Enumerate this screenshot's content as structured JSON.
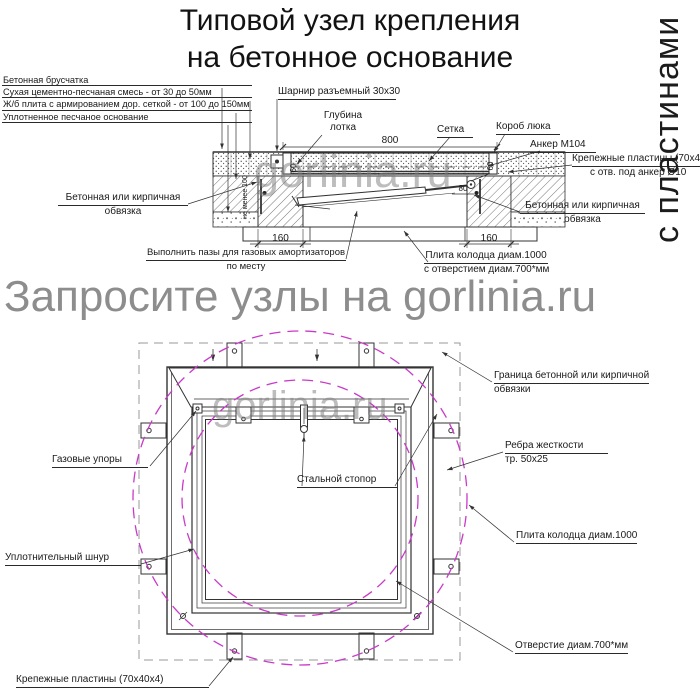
{
  "title": {
    "line1": "Типовой узел крепления",
    "line2": "на бетонное основание"
  },
  "watermark": {
    "vertical": "с пластинами",
    "banner": "Запросите узлы на gorlinia.ru",
    "site": "gorlinia.ru"
  },
  "section": {
    "layer_labels": {
      "l1": "Бетонная брусчатка",
      "l2": "Сухая цементно-песчаная смесь - от 30 до 50мм",
      "l3": "Ж/б плита с армированием дор. сеткой - от 100 до 150мм",
      "l4": "Уплотненное песчаное основание"
    },
    "labels": {
      "hinge": "Шарнир разъемный 30x30",
      "depth_line1": "Глубина",
      "depth_line2": "лотка",
      "mesh": "Сетка",
      "box": "Короб люка",
      "anchor": "Анкер М104",
      "plates_line1": "Крепежные пластины (70x40x4)",
      "plates_line2": "с отв. под анкер Ø10",
      "edging_line1": "Бетонная или кирпичная",
      "edging_line2": "обвязка",
      "grooves_line1": "Выполнить пазы для газовых амортизаторов",
      "grooves_line2": "по месту",
      "slab_line1": "Плита колодца диам.1000",
      "slab_line2": "с отверстием диам.700*мм"
    },
    "dims": {
      "width": "800",
      "left_offset": "160",
      "right_offset": "160",
      "depth_left": "60",
      "depth_right": "60",
      "anchor_offset": "80",
      "min_depth": "не менее 100"
    }
  },
  "plan": {
    "labels": {
      "border_line1": "Граница бетонной или кирпичной",
      "border_line2": "обвязки",
      "gas_struts": "Газовые упоры",
      "stopper": "Стальной стопор",
      "ribs_line1": "Ребра жесткости",
      "ribs_line2": "тр. 50x25",
      "slab": "Плита колодца диам.1000",
      "cord": "Уплотнительный шнур",
      "hole": "Отверстие диам.700*мм",
      "plates": "Крепежные пластины (70x40x4)"
    }
  },
  "colors": {
    "line": "#333333",
    "circle_magenta": "#c93ac9",
    "border_dashed_gray": "#9a9a9a",
    "watermark_gray": "#8d8d8d"
  }
}
